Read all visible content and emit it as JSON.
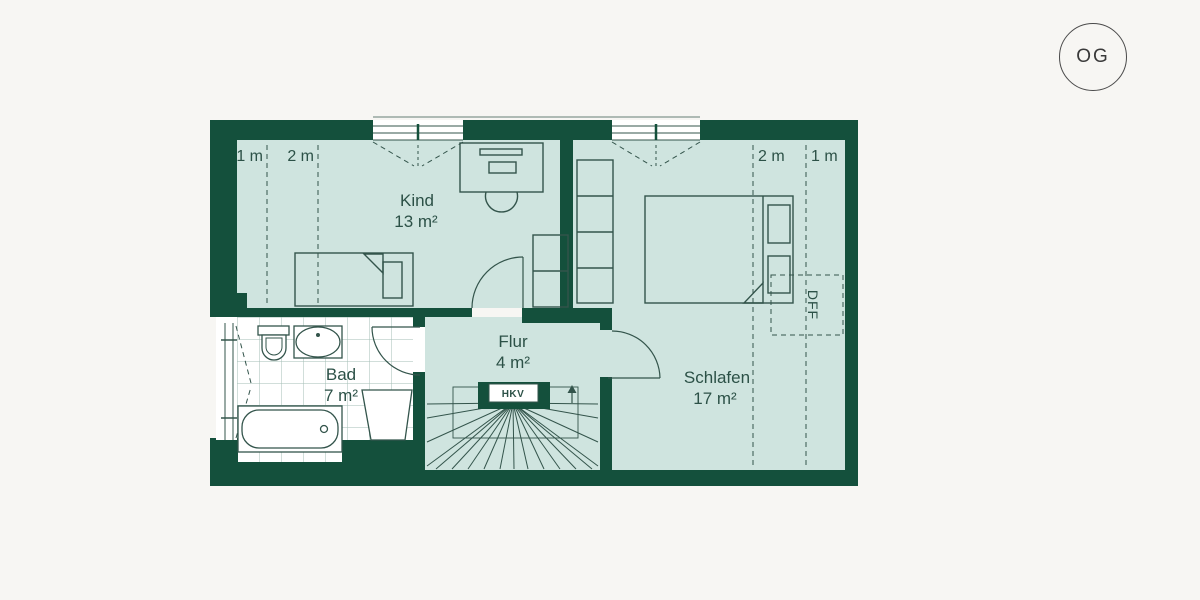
{
  "floor_badge": {
    "label": "OG"
  },
  "rooms": [
    {
      "key": "kind",
      "name": "Kind",
      "area": "13 m²"
    },
    {
      "key": "schlafen",
      "name": "Schlafen",
      "area": "17 m²"
    },
    {
      "key": "bad",
      "name": "Bad",
      "area": "7 m²"
    },
    {
      "key": "flur",
      "name": "Flur",
      "area": "4 m²"
    }
  ],
  "annotations": {
    "hkv": "HKV",
    "dff": "DFF",
    "kind_measures": [
      {
        "label": "1 m"
      },
      {
        "label": "2 m"
      }
    ],
    "schlafen_measures": [
      {
        "label": "2 m"
      },
      {
        "label": "1 m"
      }
    ]
  },
  "colors": {
    "wall": "#14503c",
    "room_fill": "#cfe4df",
    "line": "#33544b",
    "tile_line": "#a3bdb6",
    "background": "#f7f6f3",
    "badge_ring": "#4a4a4a"
  }
}
